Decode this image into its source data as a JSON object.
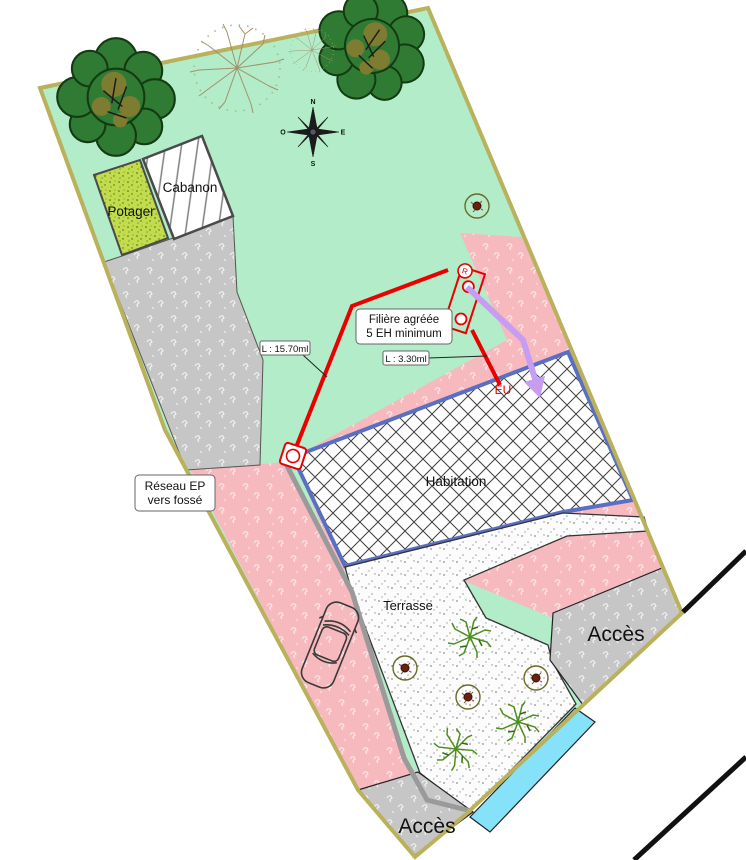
{
  "labels": {
    "potager": "Potager",
    "cabanon": "Cabanon",
    "habitation": "Habitation",
    "terrasse": "Terrasse",
    "acces_right": "Accès",
    "acces_bottom": "Accès",
    "filiere_line1": "Filière agréée",
    "filiere_line2": "5 EH minimum",
    "length_main": "L : 15.70ml",
    "length_branch": "L : 3.30ml",
    "reseau_line1": "Réseau EP",
    "reseau_line2": "vers fossé",
    "eu": "EU",
    "device_symbol": "R"
  },
  "compass": {
    "north": "N",
    "east": "E",
    "south": "S",
    "west": "O"
  },
  "colors": {
    "lawn": "#b2ecc9",
    "pink": "#f6b9be",
    "driveway": "#c6c6c6",
    "boundary": "#b9b15c",
    "habitation_border": "#5a6fc4",
    "ditch": "#86e2f8",
    "pipe_red": "#e90000",
    "pipe_purple": "#c79df2",
    "pipe_gray": "#9a9a9a",
    "potager": "#c2dc4e"
  }
}
